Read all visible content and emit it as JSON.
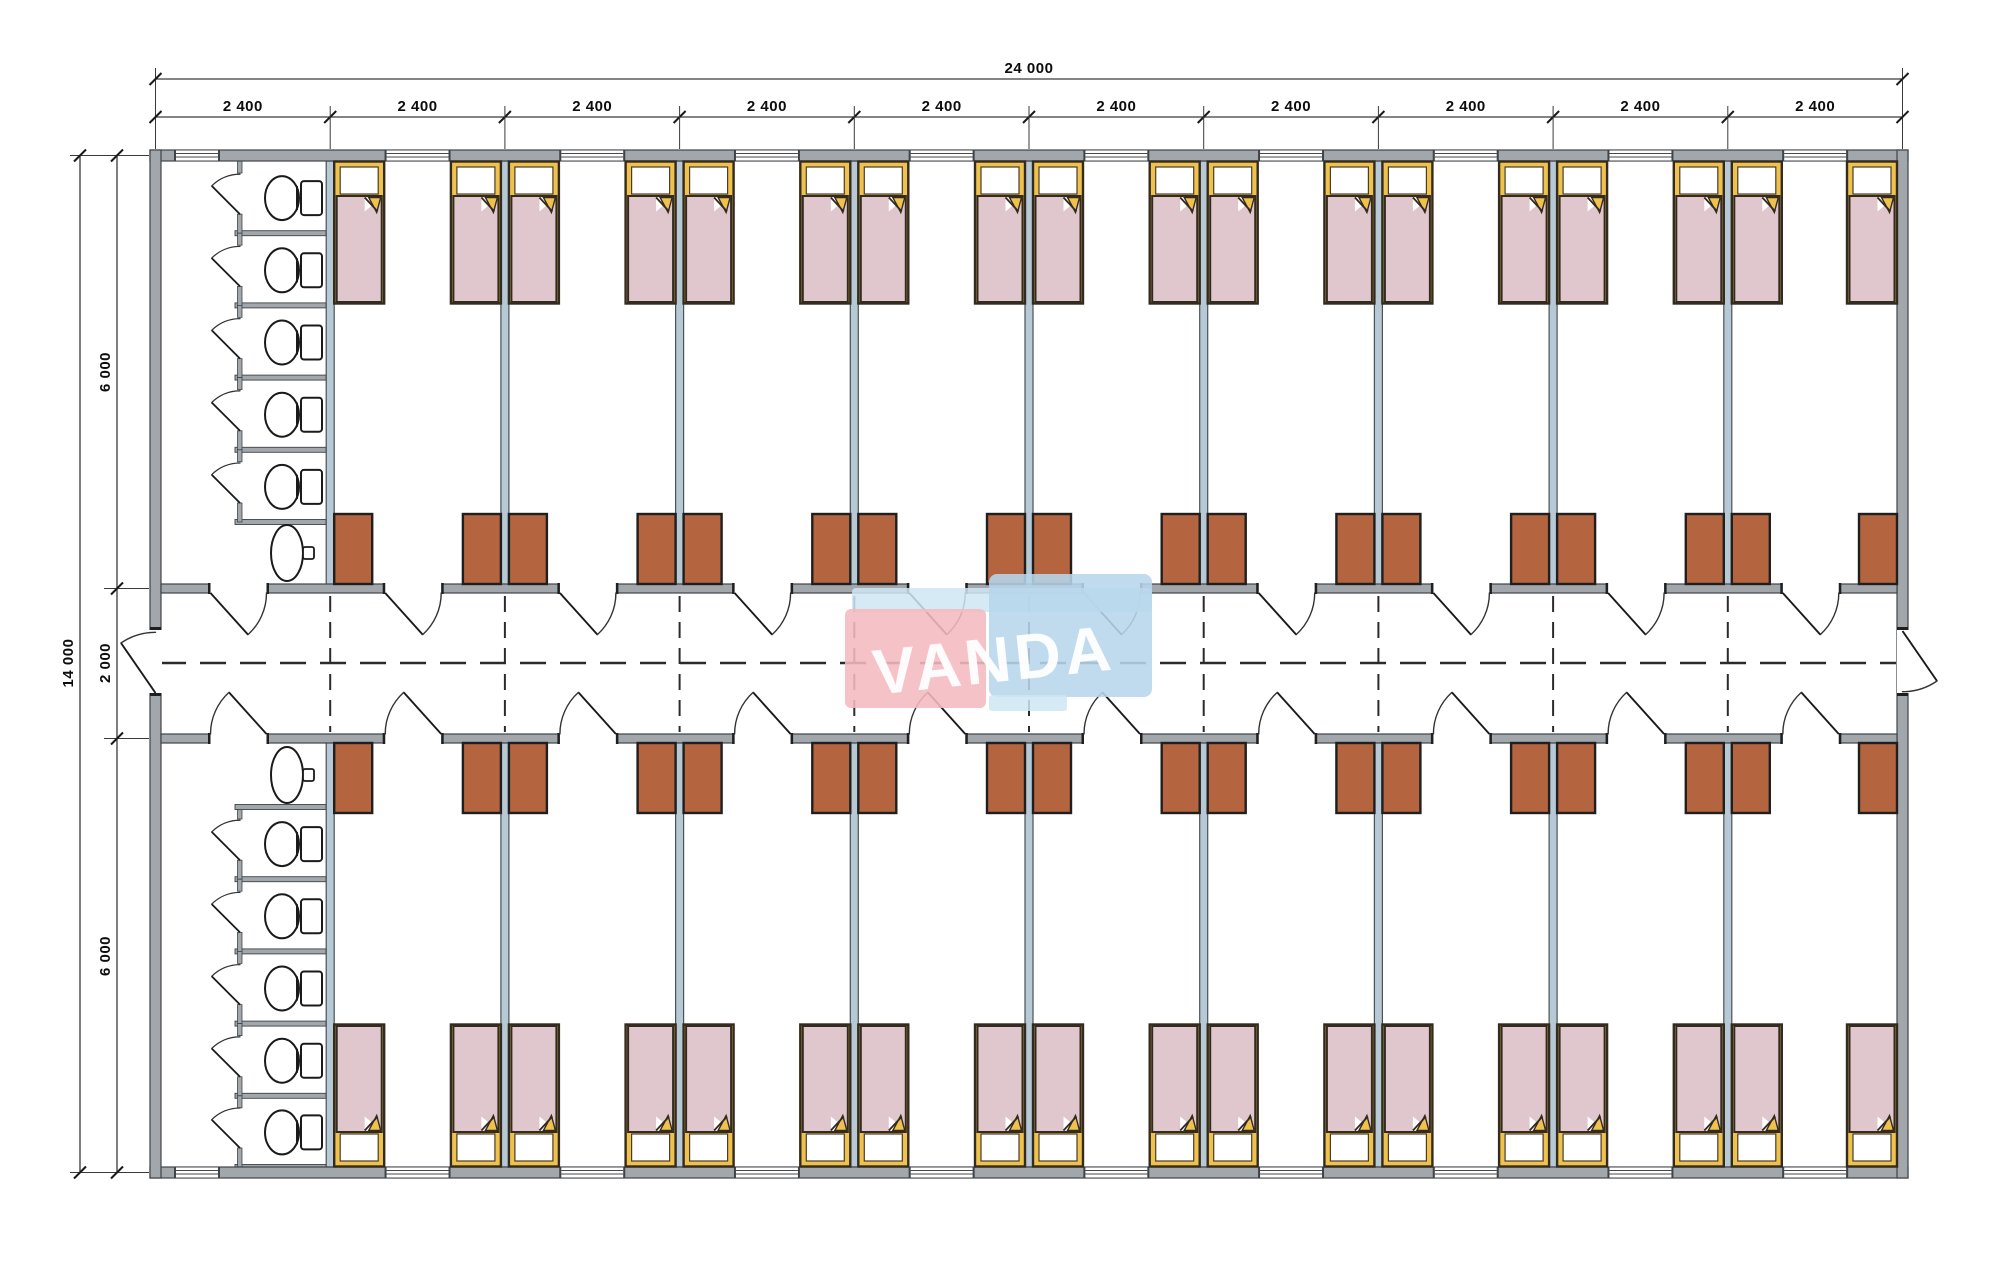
{
  "drawing": {
    "type": "dormitory-floor-plan",
    "units": "mm"
  },
  "watermark": {
    "text": "VANDA"
  },
  "dimensions": {
    "top": {
      "overall_label": "24 000",
      "segment_labels": [
        "2 400",
        "2 400",
        "2 400",
        "2 400",
        "2 400",
        "2 400",
        "2 400",
        "2 400",
        "2 400",
        "2 400"
      ]
    },
    "left": {
      "overall_label": "14 000",
      "segment_labels": [
        "6 000",
        "2 000",
        "6 000"
      ]
    }
  },
  "plan": {
    "bays": 10,
    "rooms_top_band": 9,
    "rooms_bottom_band": 9,
    "toilet_rooms": 2,
    "toilet_stalls_per_room": 5,
    "sinks_per_toilet_room": 1,
    "beds_total": 36,
    "wardrobes_total": 36,
    "room_doors": 20,
    "corridor_end_doors": 2,
    "windows_total": 20
  },
  "colors": {
    "wall_gray": "#a2a7ac",
    "partition_blue": "#b6c9d4",
    "bed_frame_yellow": "#efc24d",
    "blanket_pink": "#e0c7cd",
    "wardrobe_brown": "#b4643e",
    "line_dark": "#1a1a1a",
    "watermark_pink": "#f4b9bf",
    "watermark_blue": "#b7d6ec",
    "watermark_light_blue": "#cfe6f3"
  }
}
